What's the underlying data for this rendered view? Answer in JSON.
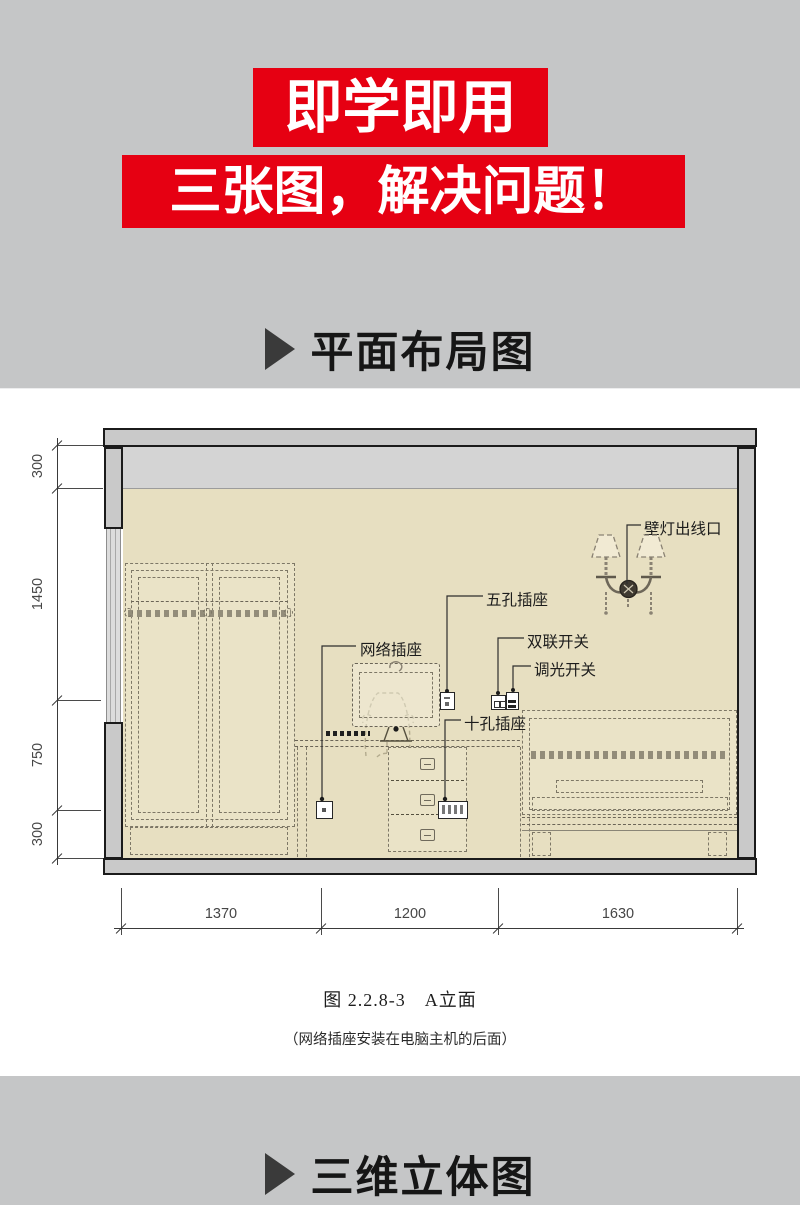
{
  "banners": {
    "line1": "即学即用",
    "line2": "三张图，解决问题！",
    "bg_color": "#e60012",
    "text_color": "#ffffff"
  },
  "sections": {
    "top_title": "平面布局图",
    "bottom_title": "三维立体图"
  },
  "drawing": {
    "labels": {
      "wall_lamp_outlet": "壁灯出线口",
      "five_hole_socket": "五孔插座",
      "network_socket": "网络插座",
      "double_switch": "双联开关",
      "dimmer_switch": "调光开关",
      "ten_hole_socket": "十孔插座"
    },
    "dims": {
      "left": [
        "300",
        "1450",
        "750",
        "300"
      ],
      "bottom": [
        "1370",
        "1200",
        "1630"
      ]
    },
    "caption": "图 2.2.8-3　A立面",
    "note": "（网络插座安装在电脑主机的后面）"
  },
  "colors": {
    "accent_red": "#e60012",
    "background_gray": "#c5c6c7",
    "wall_beige": "#e7dfc1",
    "structure_gray": "#c9c9c9"
  }
}
